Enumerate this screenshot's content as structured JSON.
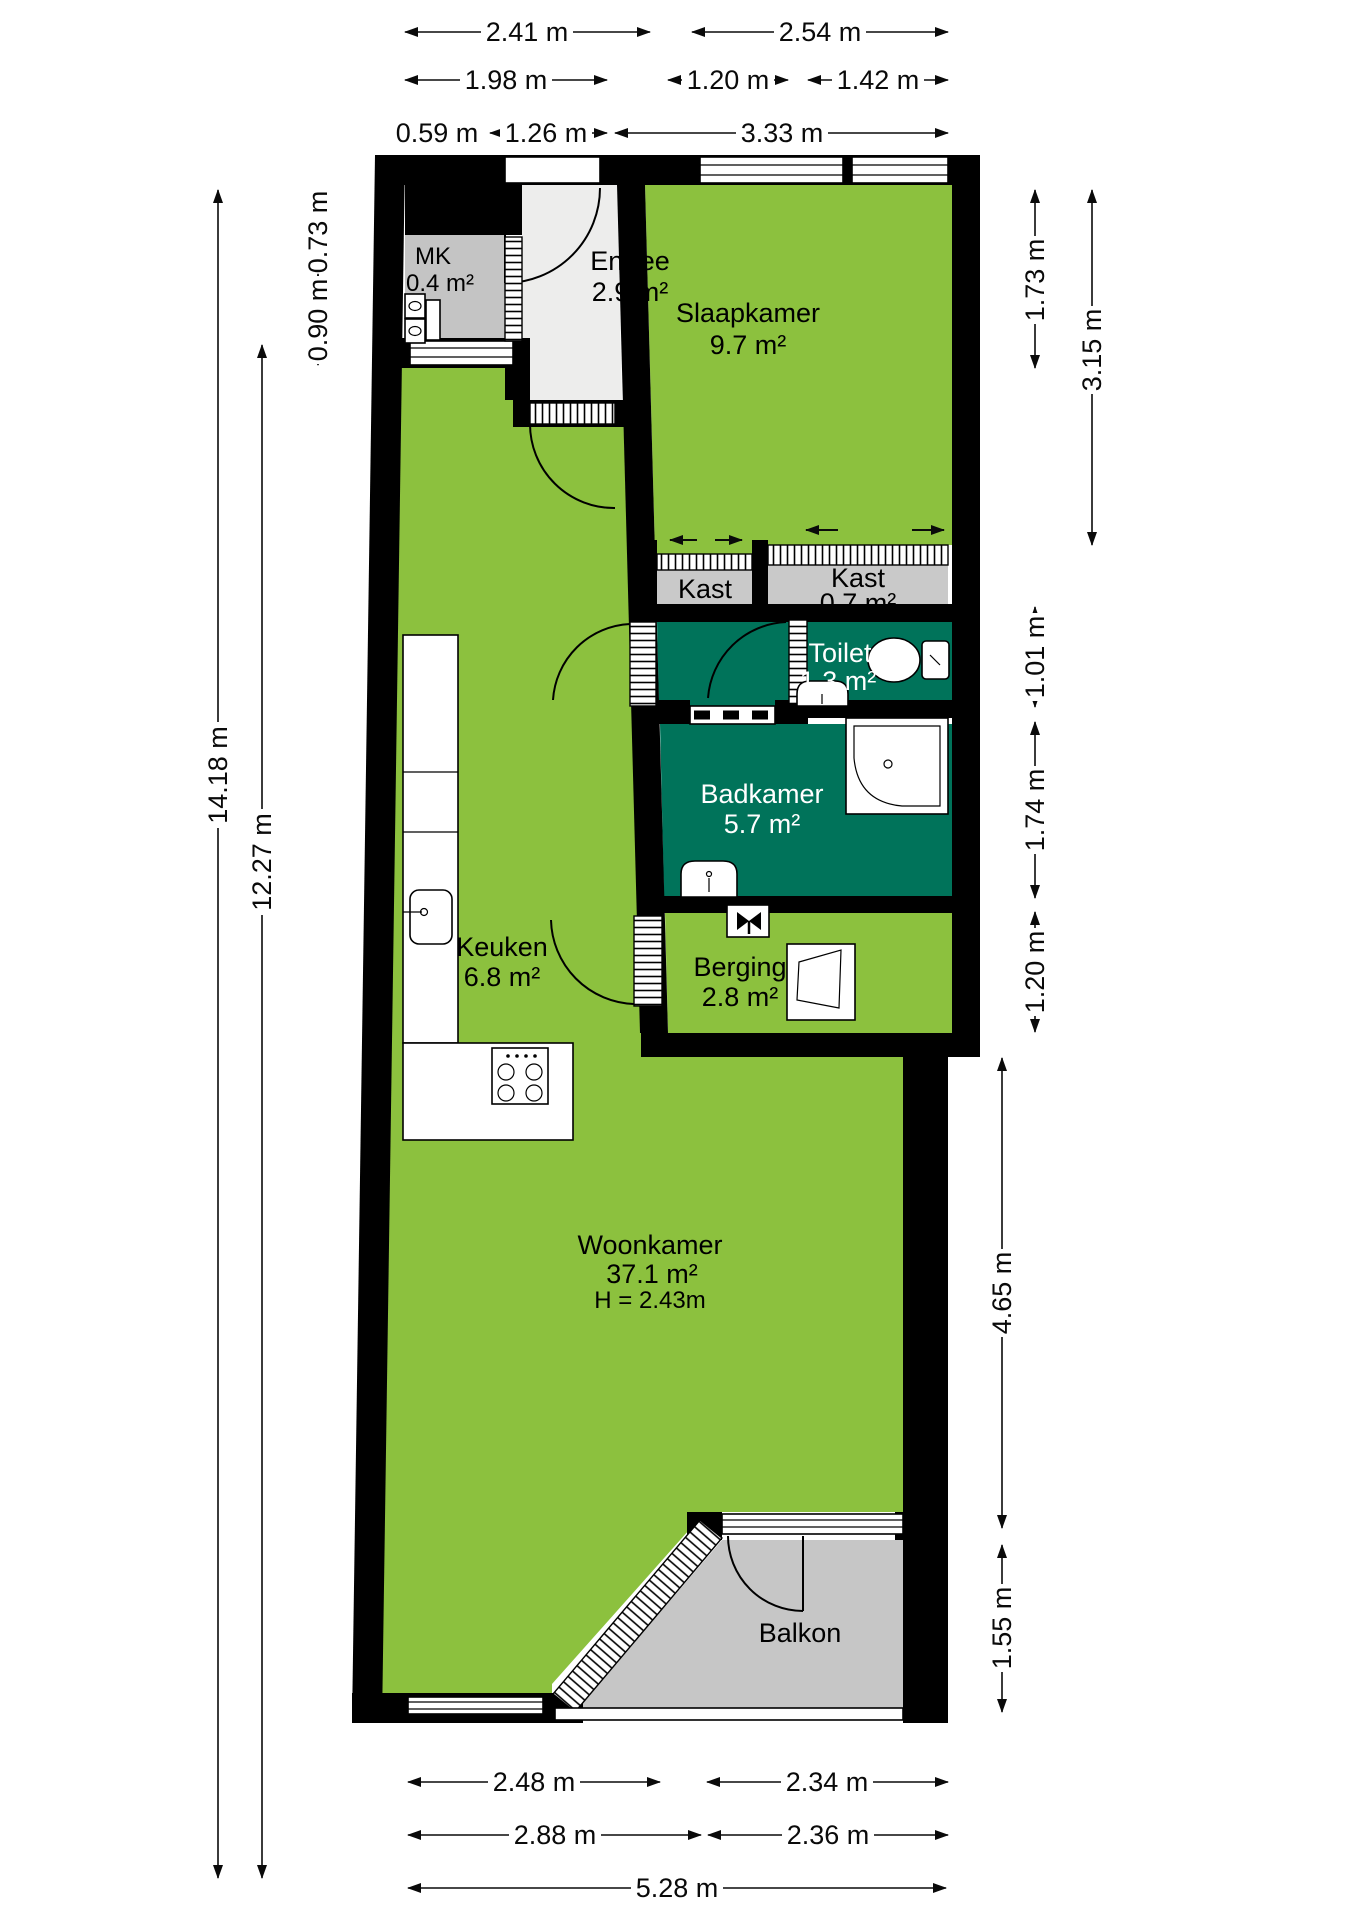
{
  "plan_type": "floorplan",
  "colors": {
    "room_green": "#8CC13E",
    "room_teal": "#00735A",
    "closet_gray": "#C9C9C9",
    "balkon_gray": "#C6C6C6",
    "entree_gray": "#EDEDEC",
    "wall": "#000000",
    "background": "#FFFFFF"
  },
  "rooms": {
    "mk": {
      "name": "MK",
      "area": "0.4 m²"
    },
    "entree": {
      "name": "Entree",
      "area": "2.9 m²"
    },
    "slaapkamer": {
      "name": "Slaapkamer",
      "area": "9.7 m²"
    },
    "kast_klein": {
      "name": "Kast"
    },
    "kast": {
      "name": "Kast",
      "area": "0.7 m²"
    },
    "toilet": {
      "name": "Toilet",
      "area": "1.3 m²"
    },
    "badkamer": {
      "name": "Badkamer",
      "area": "5.7 m²"
    },
    "berging": {
      "name": "Berging",
      "area": "2.8 m²"
    },
    "keuken": {
      "name": "Keuken",
      "area": "6.8 m²"
    },
    "woonkamer": {
      "name": "Woonkamer",
      "area": "37.1 m²",
      "height": "H = 2.43m"
    },
    "balkon": {
      "name": "Balkon"
    }
  },
  "dims": {
    "t_241": "2.41 m",
    "t_254": "2.54 m",
    "t_198": "1.98 m",
    "t_120": "1.20 m",
    "t_142": "1.42 m",
    "t_059": "0.59 m",
    "t_126": "1.26 m",
    "t_333": "3.33 m",
    "l_1418": "14.18 m",
    "l_1227": "12.27 m",
    "l_073": "0.73 m",
    "l_090": "0.90 m",
    "r_173": "1.73 m",
    "r_315": "3.15 m",
    "r_101": "1.01 m",
    "r_174": "1.74 m",
    "r_120": "1.20 m",
    "r_465": "4.65 m",
    "r_155": "1.55 m",
    "b_248": "2.48 m",
    "b_234": "2.34 m",
    "b_288": "2.88 m",
    "b_236": "2.36 m",
    "b_528": "5.28 m"
  }
}
